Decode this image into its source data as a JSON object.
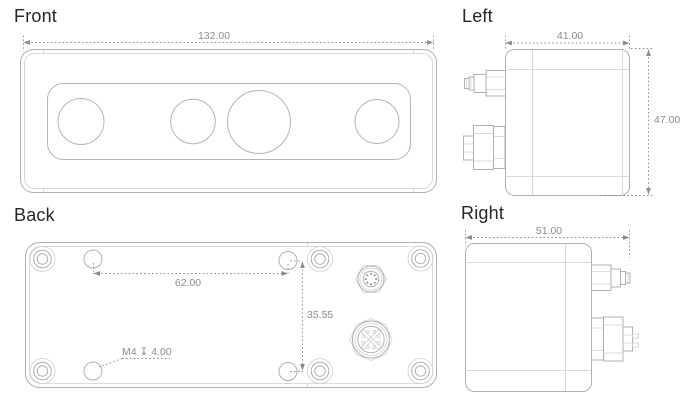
{
  "drawing": {
    "front": {
      "label": "Front",
      "width_dim": "132.00"
    },
    "left": {
      "label": "Left",
      "width_dim": "41.00",
      "height_dim": "47.00"
    },
    "back": {
      "label": "Back",
      "hole_spacing_horizontal": "62.00",
      "hole_spacing_vertical": "35.55",
      "thread_note": "M4 ↧ 4.00"
    },
    "right": {
      "label": "Right",
      "width_dim": "51.00"
    }
  },
  "colors": {
    "outline": "#b0b0b0",
    "outline_light": "#cfcfcf",
    "dimension": "#8c8c8c",
    "label_text": "#262626",
    "background": "#ffffff"
  }
}
